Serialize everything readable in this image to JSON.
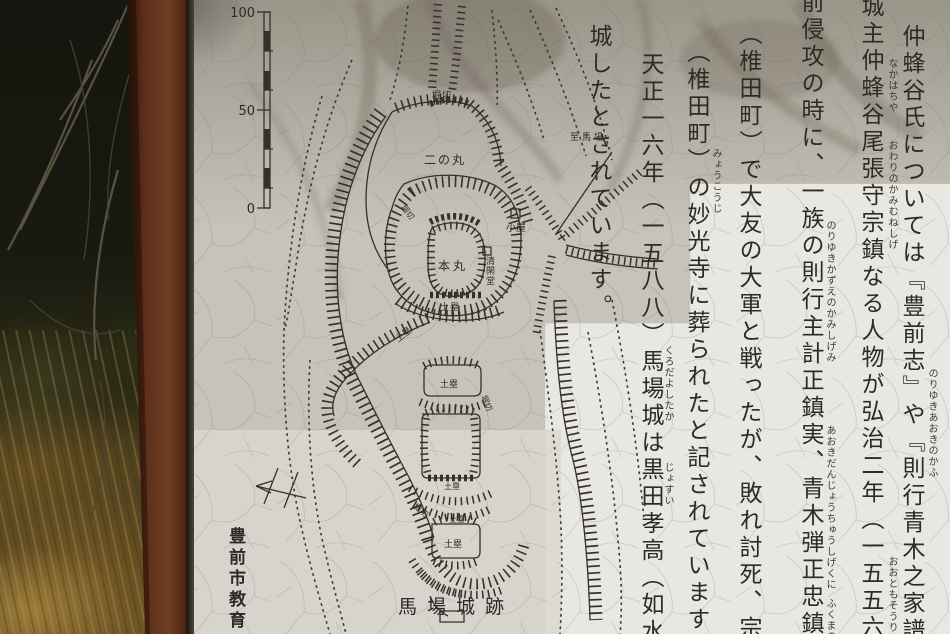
{
  "colors": {
    "ink": "#35312a",
    "paper_new": "#e8e7e2",
    "paper_aged": "#b3aea4",
    "rust_post": "#6a3a20",
    "forest_dark": "#14160f",
    "grass_brown": "#7c5d28"
  },
  "sign": {
    "map": {
      "scale": {
        "top": "100",
        "mid": "50",
        "zero": "0"
      },
      "labels": {
        "horikiri_top": "堀切",
        "ninomaru": "二の丸",
        "koya": "小屋",
        "seikando": "清閑堂",
        "honmaru": "本丸",
        "dorui_a": "土塁",
        "dorui_b": "土塁",
        "horikiri_left": "堀切",
        "dorui_c": "土塁",
        "horikiri_mid": "堀切",
        "dorui_row": "土塁",
        "horikiri_low": "堀切",
        "dorui_d": "土塁",
        "dorui_e": "土塁",
        "to_baba": "至馬場",
        "site_title": "馬場城跡",
        "credit": "豊前市教育"
      }
    },
    "text_columns": [
      {
        "text": "仲蜂谷氏については『豊前志』や『則行青木之家譜』に記録が見られ"
      },
      {
        "text": "城主仲蜂谷尾張守宗鎮なる人物が弘治二年（一五五六）、大友宗麟の豊"
      },
      {
        "text": "前侵攻の時に、一族の則行主計正鎮実、青木弾正忠鎮国と共に福間江"
      },
      {
        "text": "（椎田町）で大友の大軍と戦ったが、敗れ討死、宗鎮の遺骸は上の河"
      },
      {
        "text": "（椎田町）の妙光寺に葬られたと記されています。"
      },
      {
        "text": "天正一六年（一五八八）馬場城は黒田孝高（如水）の軍勢に攻められ"
      },
      {
        "text": "城したとされています。"
      }
    ],
    "furigana": [
      "なかはちや",
      "おわりのかみむねしげ",
      "のりゆきあおきのかふ",
      "のりゆきかずえのかみしげみ",
      "あおきだんじょうちゅうしげくに",
      "ふくまのえ",
      "みょうこうじ",
      "くろだよしたか",
      "じょすい",
      "おおともそうりん"
    ]
  }
}
